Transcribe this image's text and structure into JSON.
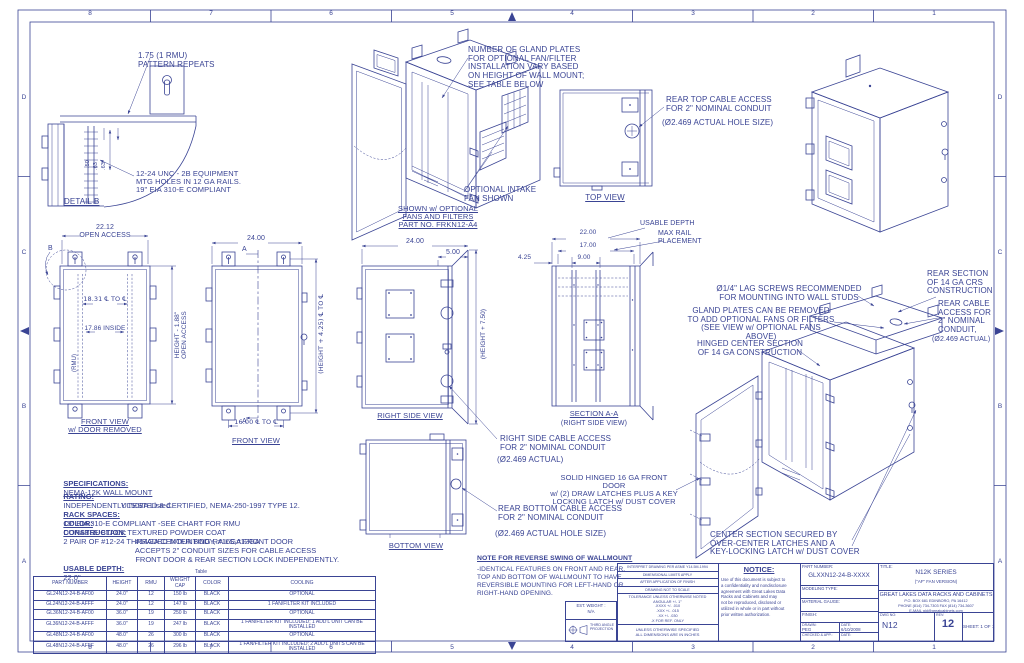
{
  "colors": {
    "ink": "#3a4494",
    "paper": "#ffffff"
  },
  "border": {
    "top": [
      "8",
      "7",
      "6",
      "5",
      "4",
      "3",
      "2",
      "1"
    ],
    "bottom": [
      "8",
      "7",
      "6",
      "5",
      "4",
      "3",
      "2",
      "1"
    ],
    "left": [
      "D",
      "C",
      "B",
      "A"
    ],
    "right": [
      "D",
      "C",
      "B",
      "A"
    ]
  },
  "detail_b": {
    "callout_pattern": "1.75   (1 RMU)\nPATTERN REPEATS",
    "dims": [
      ".50",
      ".63",
      ".63"
    ],
    "callout_holes": "12-24 UNC - 2B EQUIPMENT\nMTG HOLES IN 12 GA RAILS.\n19\" EIA 310-E COMPLIANT",
    "label": "DETAIL  B"
  },
  "iso_front": {
    "callout_gland": "NUMBER OF GLAND PLATES\nFOR OPTIONAL FAN/FILTER\nINSTALLATION VARY BASED\nON HEIGHT OF WALL MOUNT;\nSEE TABLE BELOW",
    "callout_fan": "OPTIONAL INTAKE\nFAN SHOWN",
    "caption": "SHOWN w/ OPTIONAL\nFANS AND FILTERS\nPART NO. FRKN12-A4"
  },
  "top_view": {
    "label": "TOP VIEW",
    "callout": "REAR TOP CABLE ACCESS\nFOR 2\" NOMINAL CONDUIT",
    "callout_size": "(Ø2.469 ACTUAL HOLE SIZE)"
  },
  "front_open": {
    "dim_width": "22.12\nOPEN ACCESS",
    "dim_ctc": "18.31 ℄ TO ℄",
    "dim_inside": "17.86 INSIDE",
    "dim_rmu": "(RMU)",
    "dim_height": "HEIGHT - 1.88\"\nOPEN ACCESS",
    "detail_ref": "B",
    "label": "FRONT VIEW\nw/ DOOR REMOVED"
  },
  "front_view": {
    "dim_width": "24.00",
    "marker": "A",
    "dim_height": "(HEIGHT + 4.25) ℄ TO ℄",
    "dim_ctc": "16.00 ℄ TO ℄",
    "label": "FRONT VIEW"
  },
  "right_view": {
    "dim_width": "24.00",
    "dim_offset": "5.00",
    "dim_height": "(HEIGHT + 7.50)",
    "label": "RIGHT SIDE VIEW"
  },
  "section_aa": {
    "dim_1": "22.00",
    "dim_2": "17.00",
    "dim_3": "9.00",
    "dim_4": "4.25",
    "callout_depth": "USABLE DEPTH",
    "callout_rail": "MAX RAIL\nPLACEMENT",
    "label": "SECTION A-A",
    "label_sub": "(RIGHT SIDE VIEW)"
  },
  "bottom_view": {
    "label": "BOTTOM VIEW",
    "callout_side": "RIGHT SIDE CABLE ACCESS\nFOR 2\" NOMINAL CONDUIT",
    "callout_side_size": "(Ø2.469 ACTUAL)",
    "callout_rear": "REAR BOTTOM CABLE ACCESS\nFOR 2\" NOMINAL CONDUIT",
    "callout_rear_size": "(Ø2.469 ACTUAL HOLE SIZE)"
  },
  "iso_open": {
    "callout_lag": "Ø1/4\" LAG SCREWS RECOMMENDED\nFOR MOUNTING INTO WALL STUDS",
    "callout_gland": "GLAND PLATES CAN BE REMOVED\nTO ADD OPTIONAL FANS OR FILTERS\n(SEE VIEW w/ OPTIONAL FANS ABOVE)",
    "callout_hinge": "HINGED CENTER SECTION\nOF 14 GA CONSTRUCTION",
    "callout_rear_section": "REAR SECTION\nOF 14 GA CRS\nCONSTRUCTION",
    "callout_rear_cable": "REAR CABLE\nACCESS FOR\n2\" NOMINAL\nCONDUIT,",
    "callout_rear_cable_size": "(Ø2.469 ACTUAL)",
    "callout_door": "SOLID HINGED 16 GA FRONT DOOR\nw/ (2) DRAW LATCHES PLUS A KEY\nLOCKING LATCH w/ DUST COVER",
    "callout_center": "CENTER SECTION SECURED BY\nOVER-CENTER LATCHES AND A\nKEY-LOCKING LATCH w/ DUST COVER"
  },
  "specs": {
    "l0_label": "SPECIFICATIONS:",
    "l0_text": "NEMA-12K WALL MOUNT",
    "l1_label": "RATING:",
    "l1_text": "INDEPENDENTLY TESTED & CERTIFIED, NEMA-250-1997 TYPE 12.",
    "l2_text": "UL508A Listed.",
    "l3_label": "RACK SPACES:",
    "l3_text": "19\" EIA 310-E COMPLIANT -SEE CHART FOR RMU",
    "l4_label": "COLOR:",
    "l4_text": "DURABLE BLACK TEXTURED POWDER COAT",
    "l5_label": "CONSTRUCTION:",
    "l5_text": "2 PAIR OF #12-24 THREADED MOUNTING RAILS,#12GA",
    "l6_text": "#14GA CENTER BODY, #16GA FRONT DOOR",
    "l7_text": "ACCEPTS 2\" CONDUIT SIZES FOR CABLE ACCESS",
    "l8_text": "FRONT DOOR & REAR SECTION LOCK INDEPENDENTLY.",
    "l9_label": "USABLE DEPTH:",
    "l9_text": "22.0\""
  },
  "note": {
    "title": "NOTE FOR REVERSE SWING OF WALLMOUNT",
    "body": "-IDENTICAL FEATURES ON FRONT AND REAR,\nTOP AND BOTTOM OF WALLMOUNT TO HAVE\nREVERSIBLE MOUNTING FOR LEFT-HAND OR\nRIGHT-HAND OPENING."
  },
  "table": {
    "caption": "Table",
    "headers": [
      "PART NUMBER",
      "HEIGHT",
      "RMU",
      "WEIGHT\nCAP",
      "COLOR",
      "COOLING"
    ],
    "rows": [
      [
        "GL24N12-24-B-AF00",
        "24.0\"",
        "12",
        "150 lb",
        "BLACK",
        "OPTIONAL"
      ],
      [
        "GL24N12-24-B-AFFF",
        "24.0\"",
        "12",
        "147 lb",
        "BLACK",
        "1 FAN/FILTER KIT INCLUDED"
      ],
      [
        "GL36N12-24-B-AF00",
        "36.0\"",
        "19",
        "250 lb",
        "BLACK",
        "OPTIONAL"
      ],
      [
        "GL36N12-24-B-AFFF",
        "36.0\"",
        "19",
        "247 lb",
        "BLACK",
        "1 FAN/FILTER KIT INCLUDED; 1 ADD'L UNIT CAN BE INSTALLED"
      ],
      [
        "GL48N12-24-B-AF00",
        "48.0\"",
        "26",
        "300 lb",
        "BLACK",
        "OPTIONAL"
      ],
      [
        "GL48N12-24-B-AFFF",
        "48.0\"",
        "26",
        "296 lb",
        "BLACK",
        "1 FAN/FILTER KIT INCLUDED; 2 ADD'L UNITS CAN BE INSTALLED"
      ]
    ]
  },
  "title_block": {
    "interpret_1": "INTERPRET DRAWING PER ASME Y14.5M-1994",
    "interpret_2": "DIMENSIONAL LIMITS APPLY",
    "interpret_3": "AFTER APPLICATION OF FINISH",
    "interpret_4": "DRAWING NOT TO SCALE",
    "tolerance": "TOLERANCE UNLESS OTHERWISE NOTED\nANGULAR +/- 1°\n.XXXX +/- .010\n.XXX +/- .015\n.XX +/- .030\n.X FOR REF. ONLY",
    "units": "UNLESS OTHERWISE SPECIFIED\nALL DIMENSIONS ARE IN INCHES",
    "est_weight": "EST. WEIGHT :\nN/A",
    "projection": "THIRD ANGLE\nPROJECTION",
    "notice_title": "NOTICE:",
    "notice_body": "Use of this document is subject to\na confidentiality and nondisclosure\nagreement with Great Lakes Data\nRacks and Cabinets and may\nnot be reproduced, disclosed or\nutilized in whole or in part without\nprior written authorization.",
    "part_number_label": "PART NUMBER:",
    "part_number": "GLXXN12-24-B-XXXX",
    "modeling_label": "MODELING TYPE:",
    "material_label": "MATERIAL GAUGE:",
    "finish_label": "FINISH:",
    "drawn_label": "DRAWN:",
    "drawn_by": "PEG",
    "date_label": "DATE:",
    "drawn_date": "6/10/2008",
    "checked_label": "CHECKED & APP.:",
    "title_label": "TITLE:",
    "series": "N12K SERIES",
    "series_sub": "(\"AF\" FAN VERSION)",
    "company": "GREAT LAKES DATA RACKS AND CABINETS",
    "address": "P.O. BOX 681 EDINBORO, PA 16412\nPHONE (814) 734-7303  FAX (814) 734-3607\nE-MAIL  gld@greatcabinets.com",
    "dwg_label": "DWG NO:",
    "dwg_no": "N12",
    "rev_label": "REV:",
    "rev": "12",
    "sheet": "SHEET:  1  OF  1"
  }
}
